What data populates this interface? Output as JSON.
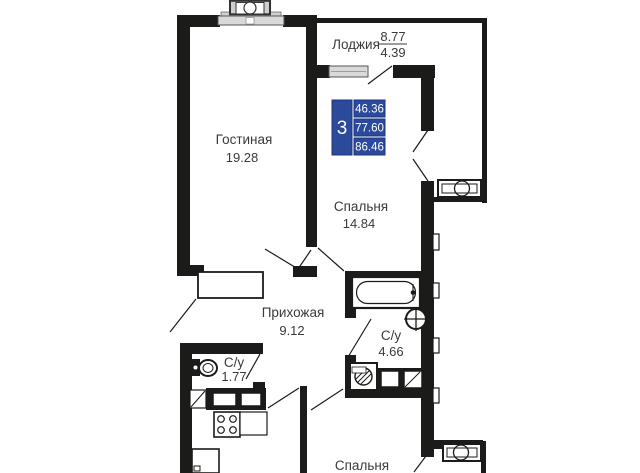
{
  "plan": {
    "badge": {
      "room_count": "3",
      "area_values": [
        "46.36",
        "77.60",
        "86.46"
      ]
    },
    "rooms": {
      "loggia": {
        "name": "Лоджия",
        "area_upper": "8.77",
        "area_lower": "4.39"
      },
      "living_room": {
        "name": "Гостиная",
        "area": "19.28"
      },
      "bedroom_1": {
        "name": "Спальня",
        "area": "14.84"
      },
      "hallway": {
        "name": "Прихожая",
        "area": "9.12"
      },
      "bathroom_1": {
        "name": "С/у",
        "area": "4.66"
      },
      "bathroom_2": {
        "name": "С/у",
        "area": "1.77"
      },
      "bedroom_2": {
        "name": "Спальня"
      }
    },
    "colors": {
      "wall": "#1b1b19",
      "badge_blue": "#2b4a9c",
      "window_gray": "#d9d9d9",
      "text": "#3a3a38"
    }
  }
}
